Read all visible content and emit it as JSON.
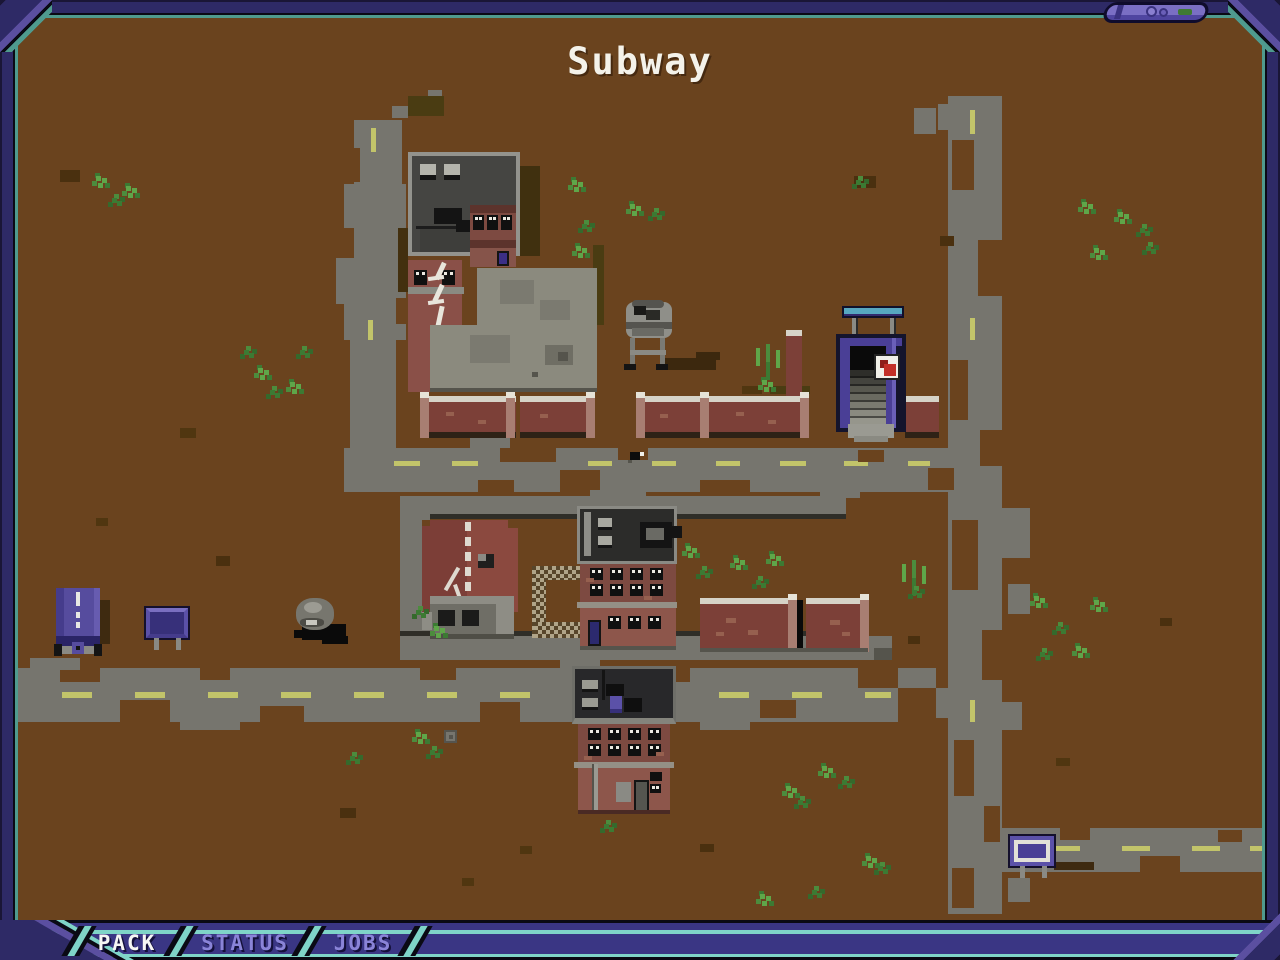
{
  "header": {
    "title": "Subway"
  },
  "tabs": {
    "items": [
      {
        "label": "PACK",
        "active": true
      },
      {
        "label": "STATUS",
        "active": false
      },
      {
        "label": "JOBS",
        "active": false
      }
    ]
  },
  "palette": {
    "frame": "#2e2a66",
    "frame_light": "#5b4fa0",
    "frame_teal": "#4f9a8e",
    "bar": "#3a3684",
    "bar_teal": "#7fd4c8",
    "tab_active_text": "#f6f6f4",
    "tab_inactive_text": "#8a84d8",
    "terrain": "#6a431e",
    "road": "#76756e",
    "road_line": "#c2c46a",
    "brick": "#7d4a41",
    "roof": "#2c2c2a",
    "grass": "#5fa649",
    "subway_purple": "#4a3f96",
    "sign_teal": "#57a7c0"
  },
  "map": {
    "landmarks": [
      "warehouse-roof",
      "brick-annex",
      "graffiti-building",
      "concrete-pad",
      "water-tower",
      "subway-entrance",
      "subway-sign",
      "white-arrow-sign",
      "brick-walls",
      "ruined-house",
      "chain-link-fence",
      "apartment-building",
      "lower-apartment-building",
      "delivery-truck",
      "billboard-left",
      "boulder",
      "billboard-right",
      "bird",
      "roads"
    ],
    "dashes": [
      [
        394,
        461,
        26,
        5
      ],
      [
        452,
        461,
        26,
        5
      ],
      [
        588,
        461,
        24,
        5
      ],
      [
        652,
        461,
        24,
        5
      ],
      [
        716,
        461,
        24,
        5
      ],
      [
        780,
        461,
        26,
        5
      ],
      [
        844,
        461,
        24,
        5
      ],
      [
        908,
        461,
        22,
        5
      ],
      [
        371,
        128,
        5,
        24
      ],
      [
        368,
        320,
        5,
        20
      ],
      [
        970,
        110,
        5,
        24
      ],
      [
        970,
        318,
        5,
        22
      ],
      [
        970,
        520,
        5,
        22
      ],
      [
        970,
        700,
        5,
        22
      ],
      [
        1052,
        846,
        28,
        5
      ],
      [
        1122,
        846,
        28,
        5
      ],
      [
        1192,
        846,
        28,
        5
      ],
      [
        1250,
        846,
        12,
        5
      ],
      [
        62,
        692,
        30,
        6
      ],
      [
        135,
        692,
        30,
        6
      ],
      [
        208,
        692,
        30,
        6
      ],
      [
        281,
        692,
        30,
        6
      ],
      [
        354,
        692,
        30,
        6
      ],
      [
        427,
        692,
        30,
        6
      ],
      [
        500,
        692,
        30,
        6
      ],
      [
        646,
        692,
        30,
        6
      ],
      [
        719,
        692,
        30,
        6
      ],
      [
        792,
        692,
        30,
        6
      ],
      [
        865,
        692,
        26,
        6
      ]
    ],
    "spots": [
      [
        344,
        228,
        10,
        30,
        "b"
      ],
      [
        396,
        298,
        10,
        26,
        "b"
      ],
      [
        352,
        148,
        8,
        34,
        "b"
      ],
      [
        500,
        446,
        56,
        16,
        "b"
      ],
      [
        560,
        470,
        40,
        22,
        "b"
      ],
      [
        618,
        446,
        30,
        14,
        "b"
      ],
      [
        700,
        480,
        50,
        12,
        "b"
      ],
      [
        858,
        450,
        26,
        12,
        "b"
      ],
      [
        928,
        468,
        26,
        22,
        "b"
      ],
      [
        478,
        480,
        36,
        12,
        "b"
      ],
      [
        952,
        140,
        22,
        50,
        "b"
      ],
      [
        978,
        240,
        24,
        56,
        "b"
      ],
      [
        950,
        360,
        18,
        60,
        "b"
      ],
      [
        980,
        430,
        22,
        36,
        "b"
      ],
      [
        952,
        520,
        26,
        70,
        "b"
      ],
      [
        982,
        630,
        20,
        50,
        "b"
      ],
      [
        954,
        740,
        20,
        56,
        "b"
      ],
      [
        984,
        806,
        16,
        36,
        "b"
      ],
      [
        952,
        868,
        22,
        40,
        "b"
      ],
      [
        1060,
        828,
        30,
        12,
        "b"
      ],
      [
        1140,
        856,
        40,
        16,
        "b"
      ],
      [
        1218,
        830,
        24,
        12,
        "b"
      ],
      [
        60,
        668,
        40,
        14,
        "b"
      ],
      [
        120,
        700,
        50,
        22,
        "b"
      ],
      [
        200,
        668,
        30,
        12,
        "b"
      ],
      [
        260,
        706,
        44,
        16,
        "b"
      ],
      [
        420,
        668,
        36,
        12,
        "b"
      ],
      [
        480,
        702,
        40,
        20,
        "b"
      ],
      [
        660,
        668,
        30,
        14,
        "b"
      ],
      [
        760,
        700,
        36,
        18,
        "b"
      ],
      [
        858,
        668,
        40,
        20,
        "b"
      ],
      [
        898,
        688,
        38,
        34,
        "b"
      ],
      [
        336,
        258,
        12,
        46,
        "g"
      ],
      [
        392,
        106,
        16,
        12,
        "g"
      ],
      [
        428,
        90,
        14,
        10,
        "g"
      ],
      [
        470,
        438,
        40,
        10,
        "g"
      ],
      [
        590,
        490,
        56,
        10,
        "g"
      ],
      [
        820,
        490,
        40,
        8,
        "g"
      ],
      [
        1000,
        508,
        30,
        50,
        "g"
      ],
      [
        1008,
        584,
        22,
        30,
        "g"
      ],
      [
        936,
        688,
        16,
        30,
        "g"
      ],
      [
        1002,
        702,
        20,
        28,
        "g"
      ],
      [
        938,
        104,
        14,
        26,
        "g"
      ],
      [
        1008,
        878,
        22,
        24,
        "g"
      ],
      [
        914,
        108,
        22,
        26,
        "g"
      ],
      [
        30,
        658,
        50,
        12,
        "g"
      ],
      [
        180,
        720,
        60,
        10,
        "g"
      ],
      [
        560,
        658,
        40,
        10,
        "g"
      ],
      [
        700,
        720,
        50,
        10,
        "g"
      ],
      [
        60,
        170,
        20,
        12,
        "d"
      ],
      [
        854,
        176,
        22,
        12,
        "d"
      ],
      [
        216,
        556,
        14,
        10,
        "d"
      ],
      [
        940,
        236,
        14,
        10,
        "d"
      ],
      [
        1160,
        618,
        12,
        8,
        "d"
      ],
      [
        340,
        808,
        16,
        10,
        "d"
      ],
      [
        700,
        844,
        14,
        8,
        "d"
      ],
      [
        908,
        636,
        12,
        8,
        "d"
      ],
      [
        762,
        640,
        10,
        6,
        "d"
      ],
      [
        180,
        428,
        16,
        10,
        "m"
      ],
      [
        96,
        518,
        12,
        8,
        "m"
      ],
      [
        742,
        386,
        20,
        8,
        "m"
      ],
      [
        1056,
        758,
        14,
        8,
        "m"
      ],
      [
        520,
        846,
        12,
        8,
        "m"
      ],
      [
        462,
        878,
        12,
        8,
        "m"
      ],
      [
        704,
        414,
        34,
        10,
        "o"
      ],
      [
        770,
        386,
        40,
        8,
        "o"
      ],
      [
        408,
        96,
        36,
        20,
        "o"
      ],
      [
        593,
        245,
        11,
        80,
        "o"
      ],
      [
        468,
        418,
        44,
        10,
        "o"
      ]
    ],
    "grass": [
      [
        96,
        176,
        "b"
      ],
      [
        112,
        198,
        "d"
      ],
      [
        126,
        186,
        "b"
      ],
      [
        244,
        350,
        "d"
      ],
      [
        258,
        368,
        "b"
      ],
      [
        290,
        382,
        "b"
      ],
      [
        300,
        350,
        "d"
      ],
      [
        270,
        390,
        "d"
      ],
      [
        572,
        180,
        "b"
      ],
      [
        582,
        224,
        "d"
      ],
      [
        576,
        246,
        "b"
      ],
      [
        630,
        204,
        "b"
      ],
      [
        652,
        212,
        "d"
      ],
      [
        856,
        180,
        "d"
      ],
      [
        1082,
        202,
        "b"
      ],
      [
        1118,
        212,
        "b"
      ],
      [
        1140,
        228,
        "d"
      ],
      [
        1094,
        248,
        "b"
      ],
      [
        1146,
        246,
        "d"
      ],
      [
        756,
        348,
        "t"
      ],
      [
        762,
        380,
        "b"
      ],
      [
        686,
        546,
        "b"
      ],
      [
        700,
        570,
        "d"
      ],
      [
        734,
        558,
        "b"
      ],
      [
        756,
        580,
        "d"
      ],
      [
        770,
        554,
        "b"
      ],
      [
        902,
        564,
        "t"
      ],
      [
        912,
        590,
        "d"
      ],
      [
        1034,
        596,
        "b"
      ],
      [
        1056,
        626,
        "d"
      ],
      [
        1076,
        646,
        "b"
      ],
      [
        1094,
        600,
        "b"
      ],
      [
        1040,
        652,
        "d"
      ],
      [
        416,
        732,
        "b"
      ],
      [
        430,
        750,
        "d"
      ],
      [
        350,
        756,
        "d"
      ],
      [
        786,
        786,
        "b"
      ],
      [
        798,
        800,
        "d"
      ],
      [
        822,
        766,
        "b"
      ],
      [
        842,
        780,
        "d"
      ],
      [
        866,
        856,
        "b"
      ],
      [
        878,
        866,
        "d"
      ],
      [
        812,
        890,
        "d"
      ],
      [
        760,
        894,
        "b"
      ],
      [
        434,
        626,
        "b"
      ],
      [
        416,
        610,
        "d"
      ],
      [
        604,
        824,
        "d"
      ]
    ]
  }
}
